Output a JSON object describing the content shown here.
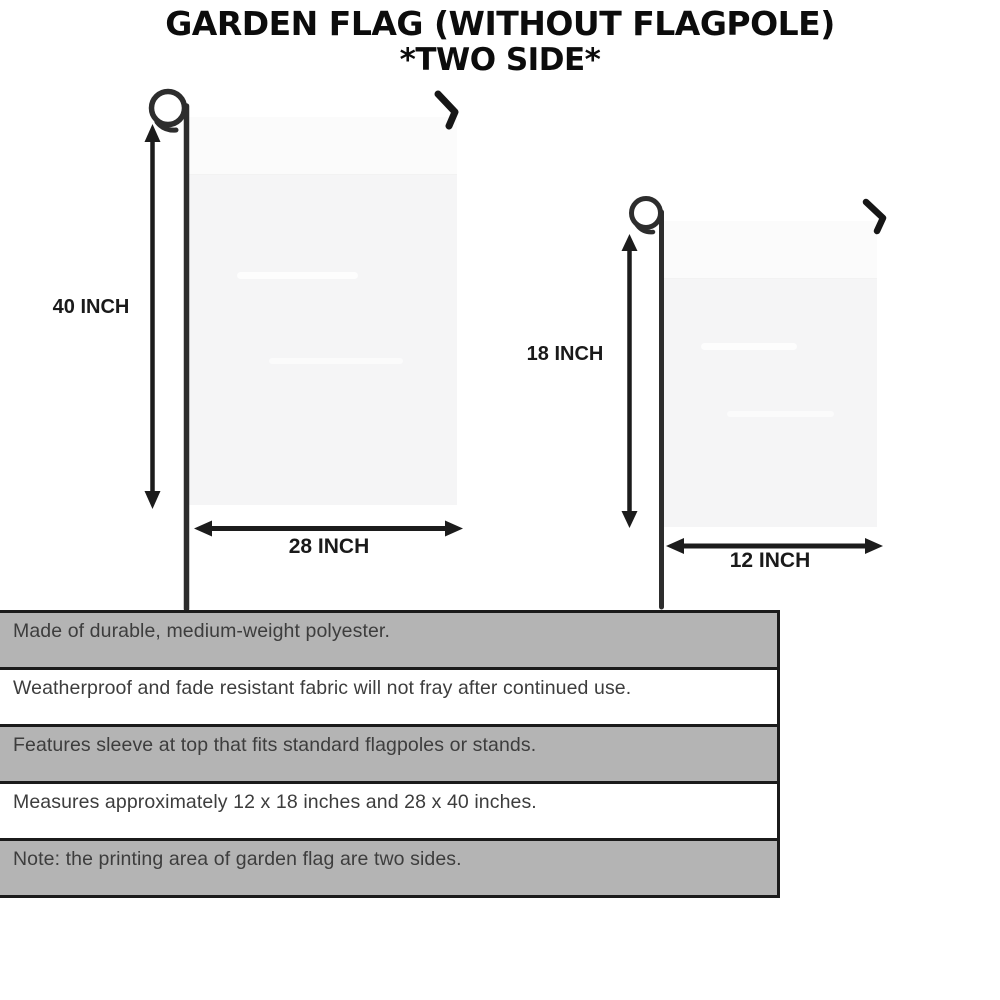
{
  "title": {
    "line1": "GARDEN FLAG (WITHOUT FLAGPOLE)",
    "line2": "*TWO SIDE*"
  },
  "diagram": {
    "large_flag": {
      "height_label": "40 INCH",
      "width_label": "28 INCH"
    },
    "small_flag": {
      "height_label": "18 INCH",
      "width_label": "12 INCH"
    }
  },
  "features": [
    {
      "text": "Made of durable, medium-weight polyester."
    },
    {
      "text": "Weatherproof and fade resistant fabric will not fray after continued use."
    },
    {
      "text": "Features sleeve at top that fits standard flagpoles or stands."
    },
    {
      "text": "Measures approximately 12 x 18 inches and 28 x 40 inches."
    },
    {
      "text": "Note: the printing area of garden flag are two sides."
    }
  ],
  "colors": {
    "bar_gray": "#b4b4b4",
    "bar_border": "#1b1b1b",
    "flag_fill": "#f5f5f6",
    "pole": "#2d2d2d",
    "arrow": "#1c1c1c",
    "title_text": "#0c0c0c",
    "body_text": "#3d3d3d"
  }
}
